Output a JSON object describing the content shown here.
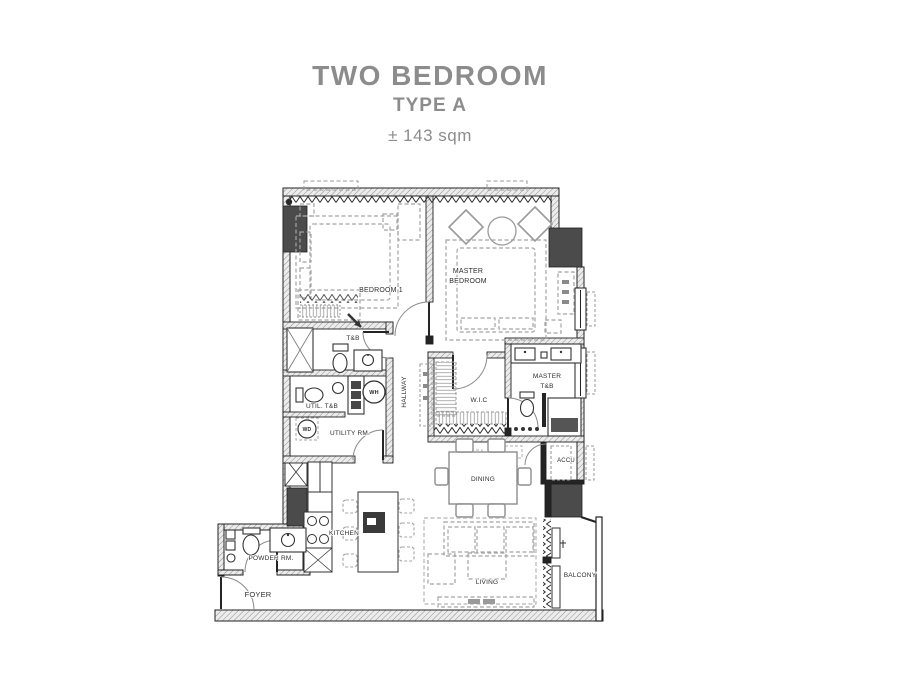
{
  "title": {
    "line1": "TWO BEDROOM",
    "line2": "TYPE A",
    "area": "± 143 sqm"
  },
  "rooms": [
    {
      "id": "bedroom-1",
      "label": "BEDROOM 1"
    },
    {
      "id": "master-bedroom",
      "label": "MASTER",
      "label2": "BEDROOM"
    },
    {
      "id": "tb",
      "label": "T&B"
    },
    {
      "id": "hallway",
      "label": "HALLWAY"
    },
    {
      "id": "wic",
      "label": "W.I.C"
    },
    {
      "id": "master-tb",
      "label": "MASTER",
      "label2": "T&B"
    },
    {
      "id": "util-tb",
      "label": "UTIL. T&B"
    },
    {
      "id": "utility-rm",
      "label": "UTILITY RM."
    },
    {
      "id": "accu",
      "label": "ACCU"
    },
    {
      "id": "dining",
      "label": "DINING"
    },
    {
      "id": "kitchen",
      "label": "KITCHEN"
    },
    {
      "id": "powder-rm",
      "label": "POWDER RM."
    },
    {
      "id": "living",
      "label": "LIVING"
    },
    {
      "id": "foyer",
      "label": "FOYER"
    },
    {
      "id": "balcony",
      "label": "BALCONY"
    }
  ],
  "equipment": {
    "water_heater": "WH",
    "washer_dryer": "WD"
  },
  "colors": {
    "title": "#8c8c8c",
    "wall": "#242424",
    "column": "#4b4b4b",
    "furniture": "#a4a4a4",
    "label": "#2d2d2d"
  }
}
